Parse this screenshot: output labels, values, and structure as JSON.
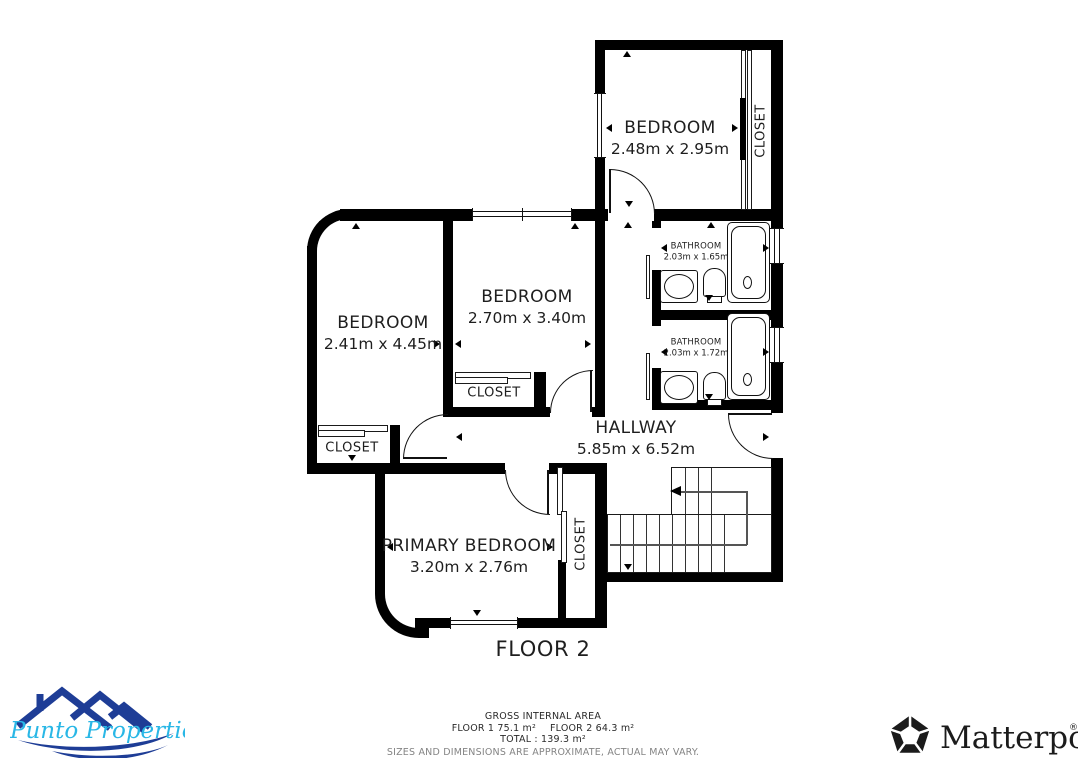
{
  "floorplan": {
    "floor_label": "FLOOR 2",
    "rooms": [
      {
        "name": "BEDROOM",
        "dimensions": "2.48m x 2.95m"
      },
      {
        "name": "BEDROOM",
        "dimensions": "2.70m x 3.40m"
      },
      {
        "name": "BEDROOM",
        "dimensions": "2.41m x 4.45m"
      },
      {
        "name": "BATHROOM",
        "dimensions": "2.03m x 1.65m"
      },
      {
        "name": "BATHROOM",
        "dimensions": "2.03m x 1.72m"
      },
      {
        "name": "HALLWAY",
        "dimensions": "5.85m x 6.52m"
      },
      {
        "name": "PRIMARY BEDROOM",
        "dimensions": "3.20m x 2.76m"
      }
    ],
    "closets": [
      {
        "label": "CLOSET"
      },
      {
        "label": "CLOSET"
      },
      {
        "label": "CLOSET"
      },
      {
        "label": "CLOSET"
      }
    ],
    "wall_color": "#000000"
  },
  "footer": {
    "area_title": "GROSS INTERNAL AREA",
    "floor1_area": "FLOOR 1 75.1 m²",
    "floor2_area": "FLOOR 2 64.3 m²",
    "total_area": "TOTAL :  139.3 m²",
    "disclaimer": "SIZES AND DIMENSIONS ARE APPROXIMATE, ACTUAL MAY VARY."
  },
  "branding": {
    "agency": {
      "name": "Punto Properties",
      "roof_color": "#1e3d96",
      "text_color": "#29b7e6"
    },
    "provider": {
      "name": "Matterport",
      "registered_mark": "®",
      "color": "#1b1b1b"
    }
  }
}
